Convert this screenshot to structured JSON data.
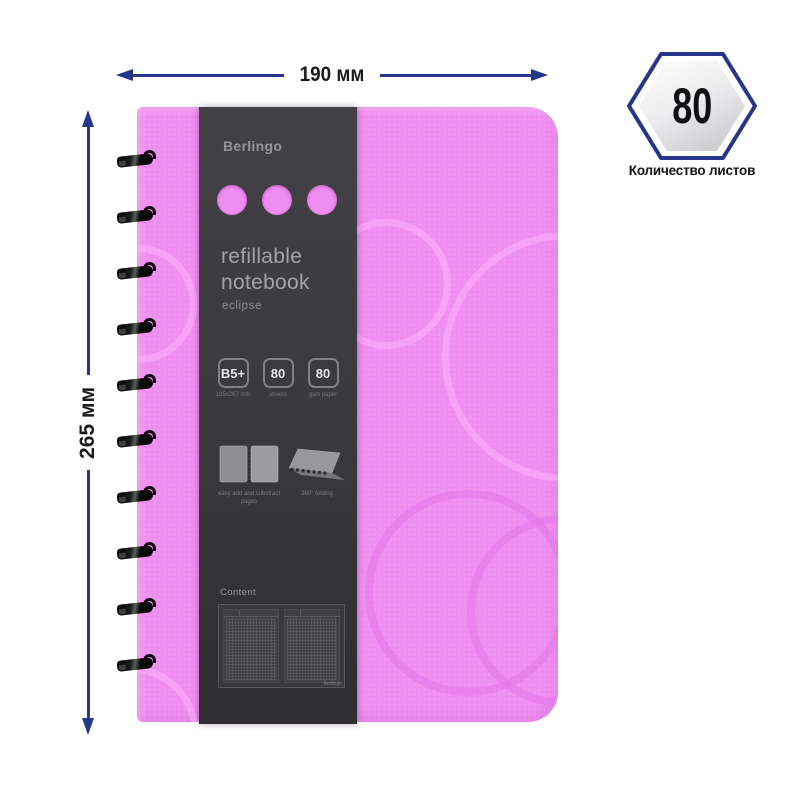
{
  "annotations": {
    "width_label": "190 мм",
    "height_label": "265 мм",
    "sheet_count": {
      "value": "80",
      "label": "Количество листов"
    }
  },
  "notebook": {
    "brand": "Berlingo",
    "title_line1": "refillable",
    "title_line2": "notebook",
    "series": "eclipse",
    "specs": [
      {
        "value": "B5+",
        "caption": "185x267 mm"
      },
      {
        "value": "80",
        "caption": "sheets"
      },
      {
        "value": "80",
        "caption": "gsm paper"
      }
    ],
    "features": [
      {
        "icon": "open-notebook-icon",
        "label": "easy add and substract pages"
      },
      {
        "icon": "360-folding-icon",
        "label": "360° folding"
      }
    ],
    "content_section": {
      "label": "Content",
      "brand_small": "Berlingo"
    }
  },
  "colors": {
    "accent_blue": "#26368b",
    "cover_pink": "#ef8df1",
    "sleeve_dark": "#3a3a3c",
    "text_dark": "#1b1b1d"
  }
}
